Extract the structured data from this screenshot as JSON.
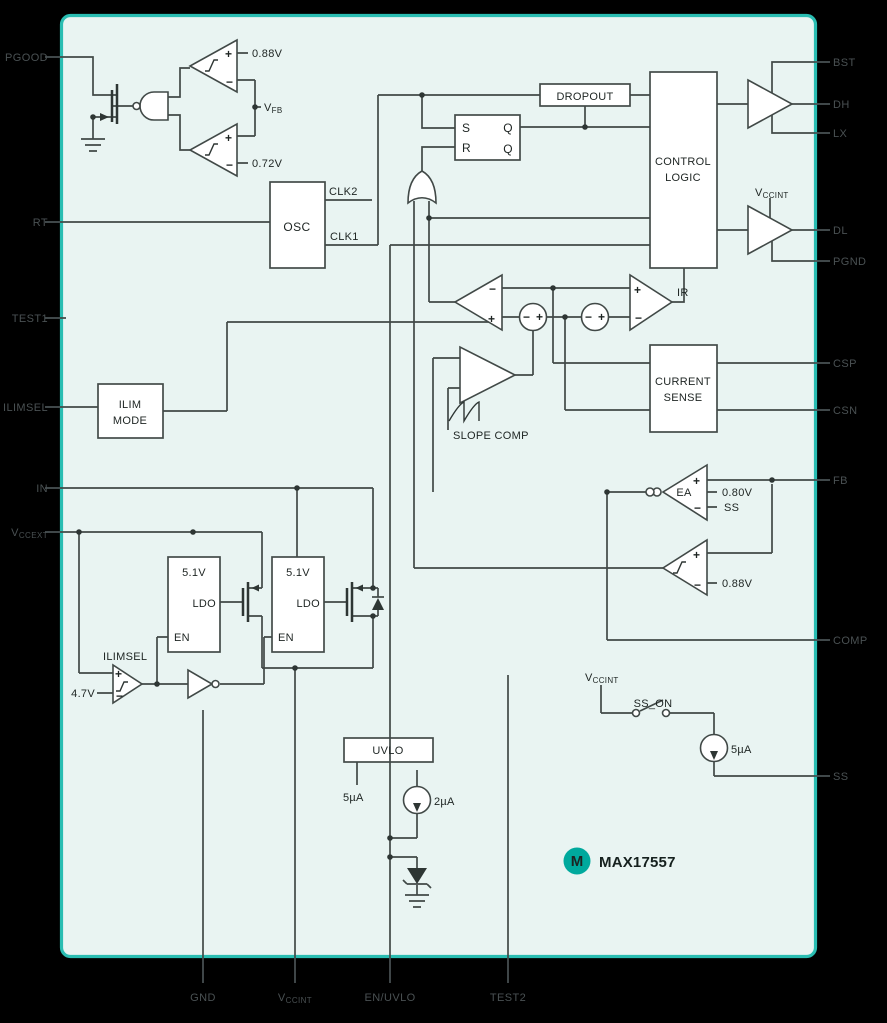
{
  "colors": {
    "canvas_bg": "#000000",
    "sheet_bg": "#e9f4f2",
    "sheet_border": "#2abdb2",
    "wire": "#414947",
    "logo_teal": "#00a99d"
  },
  "pins": {
    "left": [
      {
        "label": "PGOOD"
      },
      {
        "label": "RT"
      },
      {
        "label": "TEST1"
      },
      {
        "label": "ILIMSEL"
      },
      {
        "label": "IN"
      },
      {
        "main": "V",
        "sub": "CCEXT"
      }
    ],
    "right": [
      {
        "label": "BST"
      },
      {
        "label": "DH"
      },
      {
        "label": "LX"
      },
      {
        "label": "DL"
      },
      {
        "label": "PGND"
      },
      {
        "label": "CSP"
      },
      {
        "label": "CSN"
      },
      {
        "label": "FB"
      },
      {
        "label": "COMP"
      },
      {
        "label": "SS"
      }
    ],
    "bottom": [
      {
        "label": "GND"
      },
      {
        "main": "V",
        "sub": "CCINT"
      },
      {
        "label": "EN/UVLO"
      },
      {
        "label": "TEST2"
      }
    ]
  },
  "blocks": {
    "osc": "OSC",
    "dropout": "DROPOUT",
    "control_logic": {
      "line1": "CONTROL",
      "line2": "LOGIC"
    },
    "current_sense": {
      "line1": "CURRENT",
      "line2": "SENSE"
    },
    "ilim_mode": {
      "line1": "ILIM",
      "line2": "MODE"
    },
    "uvlo": "UVLO",
    "ldo1": {
      "voltage": "5.1V",
      "label": "LDO",
      "en": "EN"
    },
    "ldo2": {
      "voltage": "5.1V",
      "label": "LDO",
      "en": "EN"
    }
  },
  "latch": {
    "s": "S",
    "r": "R",
    "q": "Q",
    "qb": "Q"
  },
  "oscillator": {
    "clk1": "CLK1",
    "clk2": "CLK2"
  },
  "comparators": {
    "pgood_upper_ref": "0.88V",
    "pgood_lower_ref": "0.72V",
    "vfb": {
      "main": "V",
      "sub": "FB"
    },
    "ir_label": "IR",
    "slope_comp_label": "SLOPE COMP",
    "ea_label": "EA",
    "ea_ref": "0.80V",
    "ea_ss": "SS",
    "ovp_ref": "0.88V",
    "ilimsel_label": "ILIMSEL",
    "ilimsel_ref": "4.7V"
  },
  "signs": {
    "plus": "+",
    "minus": "−"
  },
  "currents": {
    "uvlo_bias": "5µA",
    "en_uvlo_source": "2µA",
    "ss_source": "5µA"
  },
  "ss_circuit": {
    "vccint": {
      "main": "V",
      "sub": "CCINT"
    },
    "switch_label": "SS_ON"
  },
  "driver": {
    "vccint": {
      "main": "V",
      "sub": "CCINT"
    }
  },
  "logo": {
    "mark": "M",
    "part": "MAX17557"
  }
}
